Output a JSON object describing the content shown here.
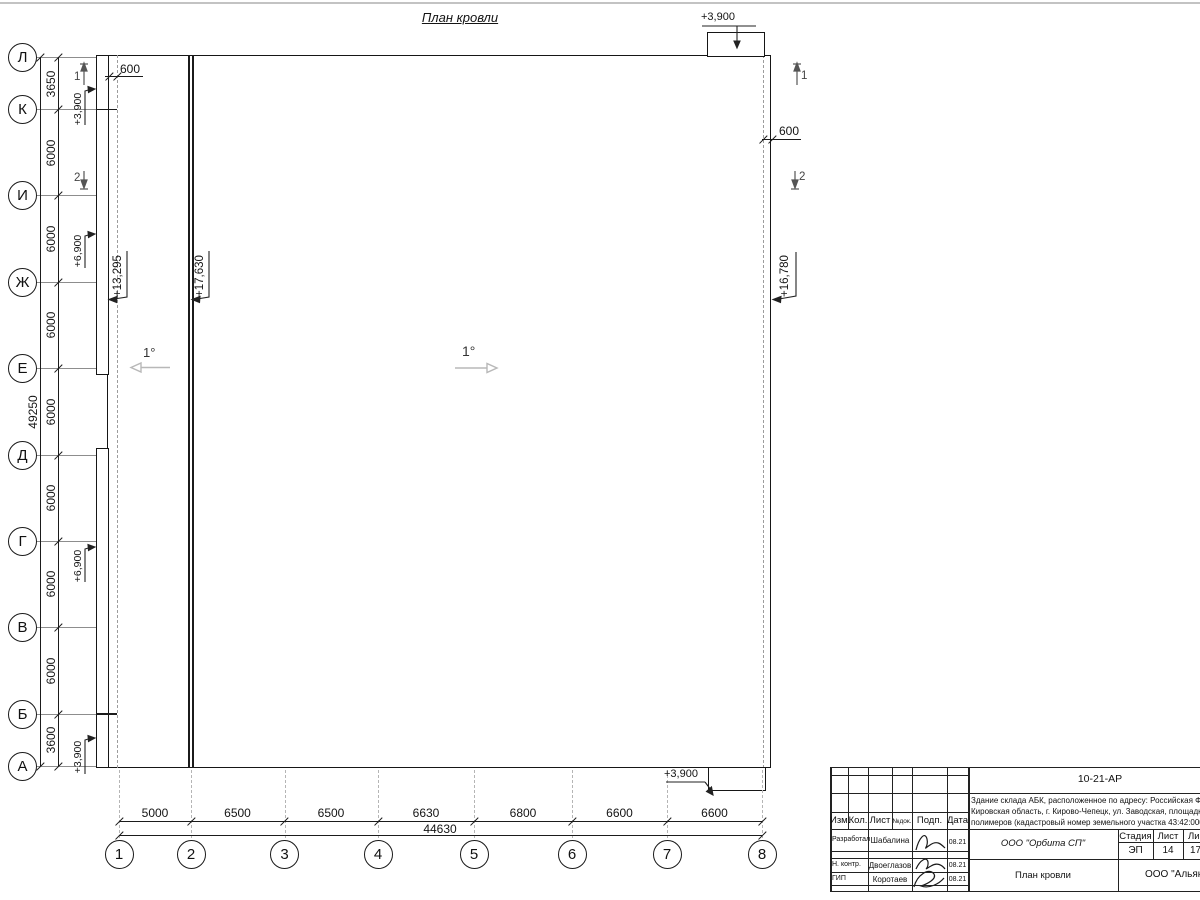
{
  "sheet": {
    "title": "План кровли"
  },
  "axes": {
    "rows": [
      "Л",
      "К",
      "И",
      "Ж",
      "Е",
      "Д",
      "Г",
      "В",
      "Б",
      "А"
    ],
    "cols": [
      "1",
      "2",
      "3",
      "4",
      "5",
      "6",
      "7",
      "8"
    ]
  },
  "dims": {
    "left_segments": [
      "3650",
      "6000",
      "6000",
      "6000",
      "6000",
      "6000",
      "6000",
      "6000",
      "3600"
    ],
    "left_total": "49250",
    "bottom_segments": [
      "5000",
      "6500",
      "6500",
      "6630",
      "6800",
      "6600",
      "6600"
    ],
    "bottom_total": "44630",
    "offset_left": "600",
    "offset_right": "600"
  },
  "elevations": {
    "left_roof": "+13,295",
    "main_roof": "+17,630",
    "right_eave": "+16,780",
    "canopy_top": "+3,900",
    "canopy_bottom": "+3,900",
    "strip_top": "+3,900",
    "strip_upper": "+6,900",
    "strip_lower": "+6,900",
    "strip_bottom": "+3,900"
  },
  "slopes": {
    "left": "1°",
    "main": "1°"
  },
  "sections": {
    "mark1": "1",
    "mark2": "2"
  },
  "stamp": {
    "doc_code": "10-21-АР",
    "project_line1": "Здание склада АБК, расположенное по адресу: Российская Феде",
    "project_line2": "Кировская область, г. Кирово-Чепецк, ул. Заводская, площадка з",
    "project_line3": "полимеров (кадастровый номер земельного участка 43:42:00000",
    "cols": [
      "Изм.",
      "Кол.",
      "Лист",
      "№док.",
      "Подп.",
      "Дата"
    ],
    "rows": [
      {
        "role": "Разработал",
        "name": "Шабалина",
        "date": "08.21"
      },
      {
        "role": "Н. контр.",
        "name": "Двоеглазов",
        "date": "08.21"
      },
      {
        "role": "ГИП",
        "name": "Коротаев",
        "date": "08.21"
      }
    ],
    "org": "ООО \"Орбита СП\"",
    "sheet_name": "План кровли",
    "client": "ООО \"Альянс",
    "stage": {
      "h1": "Стадия",
      "h2": "Лист",
      "h3": "Ли",
      "v1": "ЭП",
      "v2": "14",
      "v3": "17"
    }
  }
}
